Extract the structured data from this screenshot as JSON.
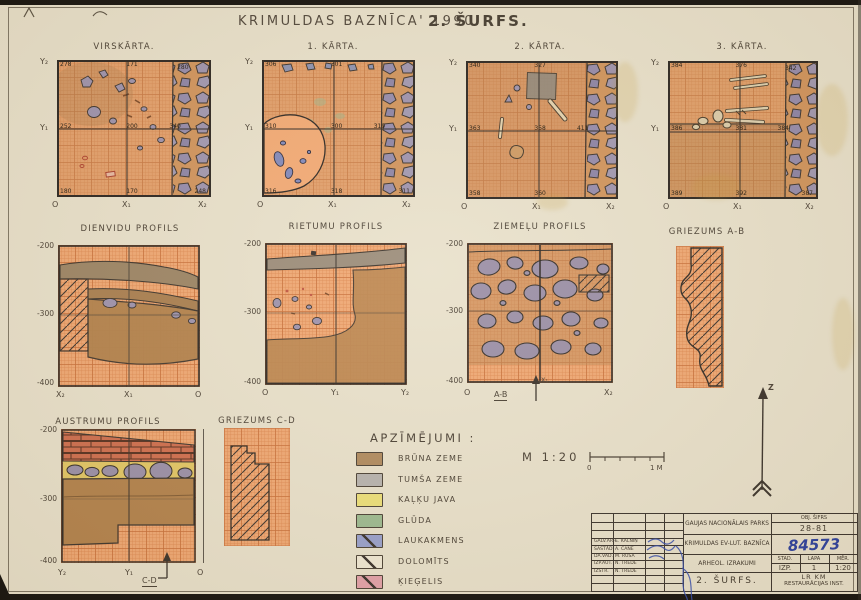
{
  "title": {
    "main": "KRIMULDAS  BAZNĪCA' 1990.",
    "sub": "2. ŠURFS."
  },
  "plans": [
    {
      "title": "VIRSKĀRTA.",
      "axis": {
        "left_top": "Y₂",
        "left_mid": "Y₁",
        "bottom": [
          "O",
          "X₁",
          "X₂"
        ]
      },
      "numbers": {
        "tl": "278",
        "tm": "171",
        "tr": "280",
        "ml": "252",
        "mm": "200",
        "mr": "340",
        "bl": "180",
        "bm": "170",
        "br": "248"
      }
    },
    {
      "title": "1. KĀRTA.",
      "axis": {
        "left_top": "Y₂",
        "left_mid": "Y₁",
        "bottom": [
          "O",
          "X₁",
          "X₂"
        ]
      },
      "numbers": {
        "tl": "306",
        "tm": "301",
        "tr": "",
        "ml": "310",
        "mm": "300",
        "mr": "319",
        "bl": "316",
        "bm": "318",
        "br": "311"
      }
    },
    {
      "title": "2. KĀRTA.",
      "axis": {
        "left_top": "Y₂",
        "left_mid": "Y₁",
        "bottom": [
          "O",
          "X₁",
          "X₂"
        ]
      },
      "numbers": {
        "tl": "340",
        "tm": "327",
        "tr": "",
        "ml": "363",
        "mm": "358",
        "mr": "411",
        "bl": "358",
        "bm": "360",
        "br": "362"
      }
    },
    {
      "title": "3. KĀRTA.",
      "axis": {
        "left_top": "Y₂",
        "left_mid": "Y₁",
        "bottom": [
          "O",
          "X₁",
          "X₂"
        ]
      },
      "numbers": {
        "tl": "384",
        "tm": "376",
        "tr": "342",
        "ml": "386",
        "mm": "381",
        "mr": "384",
        "bl": "389",
        "bm": "392",
        "br": "387"
      }
    }
  ],
  "profiles": [
    {
      "title": "DIENVIDU PROFILS",
      "ticks": [
        "-200",
        "-300",
        "-400"
      ],
      "bottom": [
        "X₂",
        "X₁",
        "O"
      ]
    },
    {
      "title": "RIETUMU PROFILS",
      "ticks": [
        "-200",
        "-300",
        "-400"
      ],
      "bottom": [
        "O",
        "Y₁",
        "Y₂"
      ]
    },
    {
      "title": "ZIEMEĻU PROFILS",
      "ticks": [
        "-200",
        "-300",
        "-400"
      ],
      "bottom": [
        "O",
        "X₂"
      ],
      "section": "A-B",
      "arrow_axis": "X₁"
    },
    {
      "title": "AUSTRUMU PROFILS",
      "ticks": [
        "-200",
        "-300",
        "-400"
      ],
      "bottom": [
        "Y₂",
        "Y₁",
        "O"
      ],
      "section": "C-D"
    }
  ],
  "sections": {
    "ab": "GRIEZUMS A-B",
    "cd": "GRIEZUMS C-D"
  },
  "legend": {
    "title": "APZĪMĒJUMI :",
    "items": [
      {
        "label": "BRŪNA ZEME",
        "color": "#b08a5e"
      },
      {
        "label": "TUMŠA ZEME",
        "color": "#b7b3ae"
      },
      {
        "label": "KAĻĶU JAVA",
        "color": "#ecdf78"
      },
      {
        "label": "GLŪDA",
        "color": "#9cba90"
      },
      {
        "label": "LAUKAKMENS",
        "color": "#98a0cc"
      },
      {
        "label": "DOLOMĪTS",
        "color": "#f0e8d4"
      },
      {
        "label": "ĶIEĢELIS",
        "color": "#e3a1a9"
      }
    ]
  },
  "scale": {
    "label": "M  1:20",
    "start": "0",
    "end": "1 M"
  },
  "north": {
    "label": "Z"
  },
  "title_block": {
    "code_label": "OBJ. ŠIFRS",
    "code": "28-81",
    "org": "GAUJAS NACIONĀLAIS PARKS",
    "object": "KRIMULDAS EV-LUT. BAZNĪCA",
    "inventory_no": "84573",
    "work": "ARHEOL. IZRAKUMI",
    "stage_label": "STAD.",
    "sheet_label": "LAPA",
    "scale_label": "MĒR.",
    "stage": "IZP.",
    "sheet_no": "1",
    "scale": "1:20",
    "drawing": "2. ŠURFS.",
    "institute_line1": "LR KM",
    "institute_line2": "RESTAURĀCIJAS INST.",
    "signatures": [
      {
        "role": "GALV.ARH.",
        "name": "E. KALNIŅ"
      },
      {
        "role": "SASTĀD.",
        "name": "A. CANE"
      },
      {
        "role": "DA.VAD.",
        "name": "M. RŪSA"
      },
      {
        "role": "IZP.AUT.",
        "name": "N. TRĒDE"
      },
      {
        "role": "IZSTR.",
        "name": "N. TRĒDE"
      }
    ]
  }
}
